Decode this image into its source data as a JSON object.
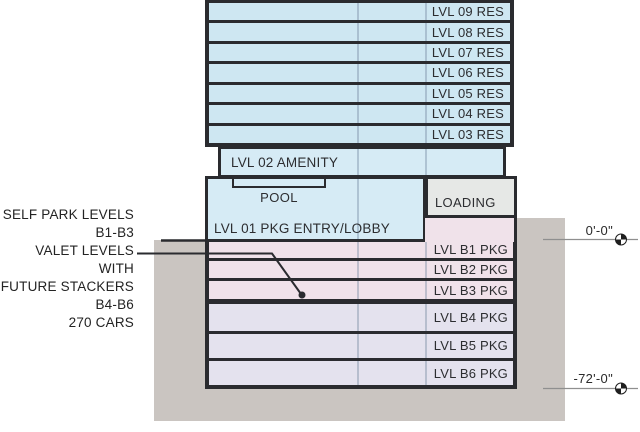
{
  "tower_levels": [
    {
      "label": "LVL 09 RES"
    },
    {
      "label": "LVL 08 RES"
    },
    {
      "label": "LVL 07 RES"
    },
    {
      "label": "LVL 06 RES"
    },
    {
      "label": "LVL 05 RES"
    },
    {
      "label": "LVL 04 RES"
    },
    {
      "label": "LVL 03 RES"
    }
  ],
  "amenity": {
    "label": "LVL 02 AMENITY"
  },
  "lvl01": {
    "label": "LVL 01 PKG ENTRY/LOBBY",
    "pool_label": "POOL"
  },
  "loading": {
    "label": "LOADING"
  },
  "basement_levels": [
    {
      "label": "LVL B1 PKG",
      "tier": "self-park"
    },
    {
      "label": "LVL B2 PKG",
      "tier": "self-park"
    },
    {
      "label": "LVL B3 PKG",
      "tier": "self-park"
    },
    {
      "label": "LVL B4 PKG",
      "tier": "valet"
    },
    {
      "label": "LVL B5 PKG",
      "tier": "valet"
    },
    {
      "label": "LVL B6 PKG",
      "tier": "valet"
    }
  ],
  "annotations": {
    "left_lines": [
      "SELF PARK LEVELS",
      "B1-B3",
      "VALET LEVELS WITH",
      "FUTURE STACKERS",
      "B4-B6",
      "270 CARS"
    ]
  },
  "elevations": {
    "ground": "0'-0\"",
    "lowest": "-72'-0\""
  },
  "colors": {
    "residential_fill": "#cee7f2",
    "podium_fill": "#d6ebf5",
    "loading_fill": "#e6e8e6",
    "self_park_fill": "#f0e2ea",
    "valet_fill": "#e4e2ee",
    "earth_fill": "#cac5c1",
    "line": "#2a2b2f"
  }
}
